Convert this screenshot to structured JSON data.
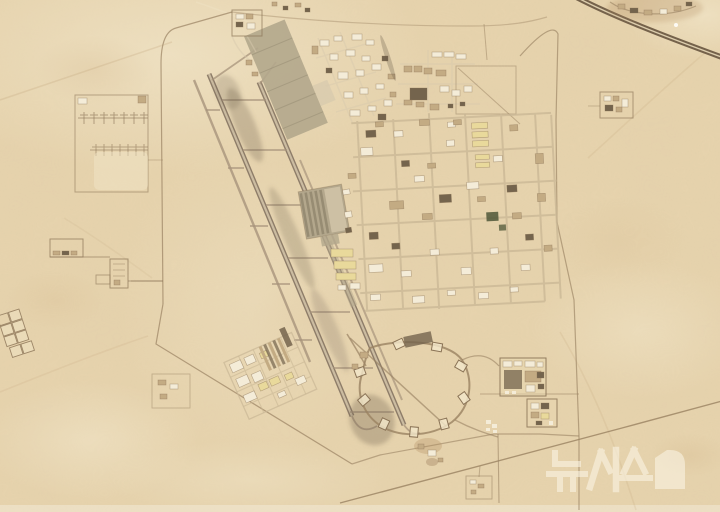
{
  "meta": {
    "type": "satellite-photograph",
    "subject": "aerial view of a desert air base with two parallel runways, aprons, building compounds, a dispersal loop taxiway and a highway at the top right"
  },
  "watermark": {
    "text": "뉴시스",
    "opacity": "0.62"
  },
  "map_features": [
    "highway",
    "highway-roadside-cluster",
    "base-perimeter-road",
    "access-roads",
    "antenna-farm",
    "west-compound",
    "southwest-pad-grid",
    "west-parallel-taxiway",
    "runway-1",
    "runway-2",
    "east-parallel-taxiway",
    "taxiway-connectors",
    "runway-shadows",
    "north-apron",
    "north-buildings",
    "northeast-buildings",
    "east-cantonment-grid",
    "central-shelter-block",
    "midfield-yellow-buildings",
    "south-cantonment",
    "dispersal-loop",
    "dispersal-pads",
    "shelter-row",
    "southeast-compounds",
    "northeast-small-compound",
    "desert-tracks",
    "newsis-watermark"
  ],
  "colors": {
    "sand": "#e7d4ae",
    "sand_light": "#f2e7ca",
    "sand_dark": "#d3b98e",
    "mottle": "#b89467",
    "pavement": "#d8caae",
    "runway": "#8e7d69",
    "runway_core": "#d6c7ab",
    "shadow": "#6b5c4a",
    "taxiway": "#a8947c",
    "apron": "#b3a78c",
    "shelter": "#847a63",
    "road_light": "#c9b795",
    "road_dark": "#9a8262",
    "outline": "#8a7356",
    "bld_white": "#f4ecd8",
    "bld_tan": "#c3ab83",
    "bld_dark": "#74644d",
    "bld_yellow": "#e9d99b",
    "green": "#4f5738",
    "highway": "#6f5c46",
    "blotch": "#b08a5e",
    "watermark": "#faf3e2"
  }
}
